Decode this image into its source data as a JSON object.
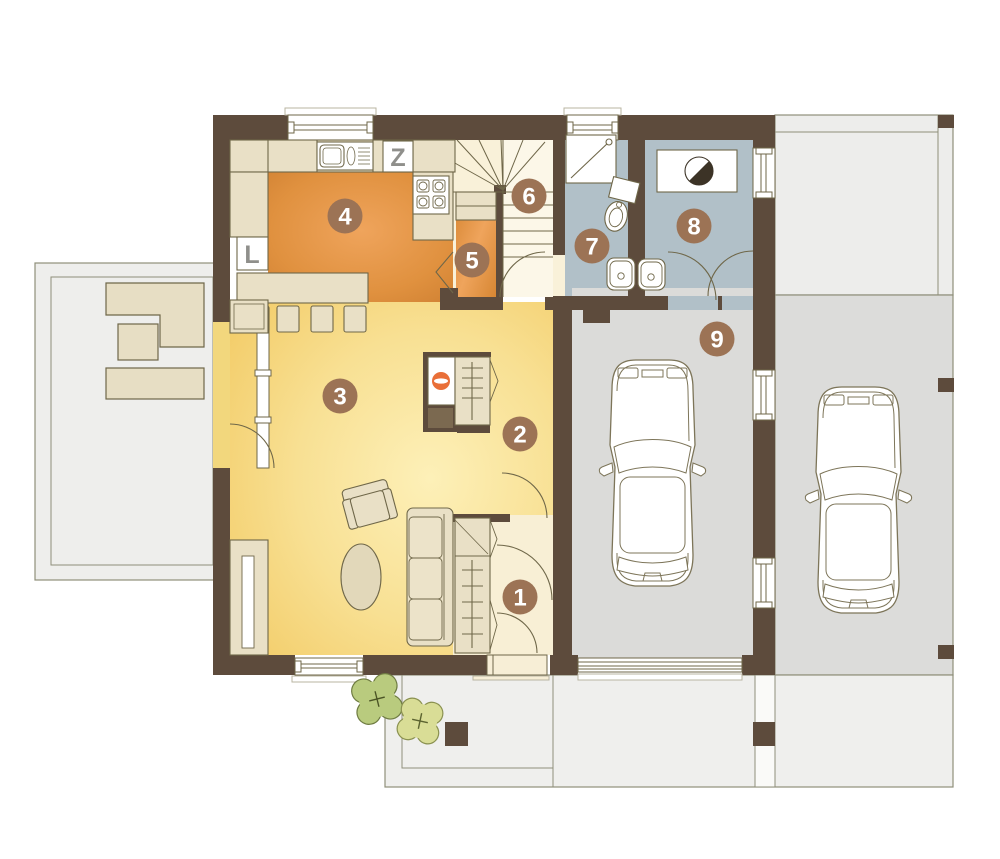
{
  "plan": {
    "room_badges": [
      {
        "id": "entry-hall",
        "number": "1",
        "cx": 520,
        "cy": 597
      },
      {
        "id": "hall",
        "number": "2",
        "cx": 520,
        "cy": 434
      },
      {
        "id": "living-room",
        "number": "3",
        "cx": 340,
        "cy": 396
      },
      {
        "id": "kitchen",
        "number": "4",
        "cx": 345,
        "cy": 216
      },
      {
        "id": "pantry",
        "number": "5",
        "cx": 472,
        "cy": 260
      },
      {
        "id": "stairs",
        "number": "6",
        "cx": 529,
        "cy": 196
      },
      {
        "id": "bathroom",
        "number": "7",
        "cx": 592,
        "cy": 246
      },
      {
        "id": "utility-room",
        "number": "8",
        "cx": 694,
        "cy": 226
      },
      {
        "id": "garage",
        "number": "9",
        "cx": 717,
        "cy": 339
      }
    ],
    "appliance_labels": [
      {
        "id": "freezer",
        "text": "Z",
        "x": 398,
        "y": 166
      },
      {
        "id": "fridge",
        "text": "L",
        "x": 252,
        "y": 263
      }
    ],
    "colors": {
      "wall": "#5d4b3c",
      "badge": "#9c7355",
      "badge_text": "#ffffff",
      "line_olive": "#6f6749",
      "beige_furniture": "#e9e0c6",
      "kitchen_floor_edge": "#cd7e30",
      "kitchen_floor_center": "#efa45c",
      "living_floor_edge": "#f3cd6a",
      "living_floor_center": "#fdf0b8",
      "hall_floor": "#f8efd5",
      "stairs_floor": "#f9f1d9",
      "bath_floor": "#b1c0c8",
      "garage_floor": "#dbdbd9",
      "carport_floor": "#dcdcda",
      "paving": "#efefed",
      "terrace": "#eeeeec",
      "fireplace_accent": "#e96f38",
      "tree_dark": "#b9cb7e",
      "tree_light": "#d9dd96",
      "car_outline": "#7d7559"
    }
  }
}
